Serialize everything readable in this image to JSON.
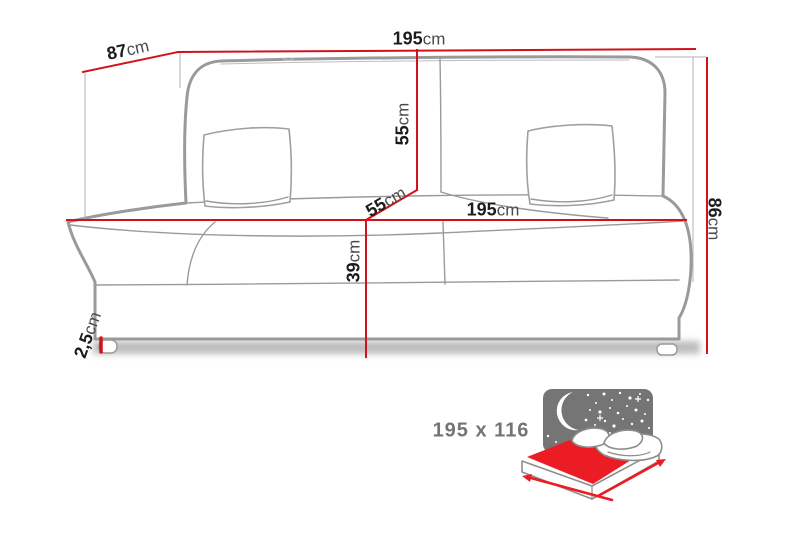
{
  "colors": {
    "dimension_red": "#d01318",
    "extension_gray": "#b0b0b0",
    "sofa_outline_gray": "#9a9a9a",
    "label_number": "#1c1c1c",
    "label_unit": "#4a4a4a",
    "size_label_gray": "#747474",
    "icon_night_gray": "#757575",
    "icon_red": "#ec1c24"
  },
  "dimensions": {
    "depth": {
      "value": "87",
      "unit": "cm"
    },
    "width_top": {
      "value": "195",
      "unit": "cm"
    },
    "backrest_height": {
      "value": "55",
      "unit": "cm"
    },
    "seat_depth": {
      "value": "55",
      "unit": "cm"
    },
    "width_seat": {
      "value": "195",
      "unit": "cm"
    },
    "seat_height": {
      "value": "39",
      "unit": "cm"
    },
    "total_height": {
      "value": "86",
      "unit": "cm"
    },
    "leg_height": {
      "value": "2,5",
      "unit": "cm"
    }
  },
  "sleeping_area": {
    "size_label": "195 x 116"
  }
}
